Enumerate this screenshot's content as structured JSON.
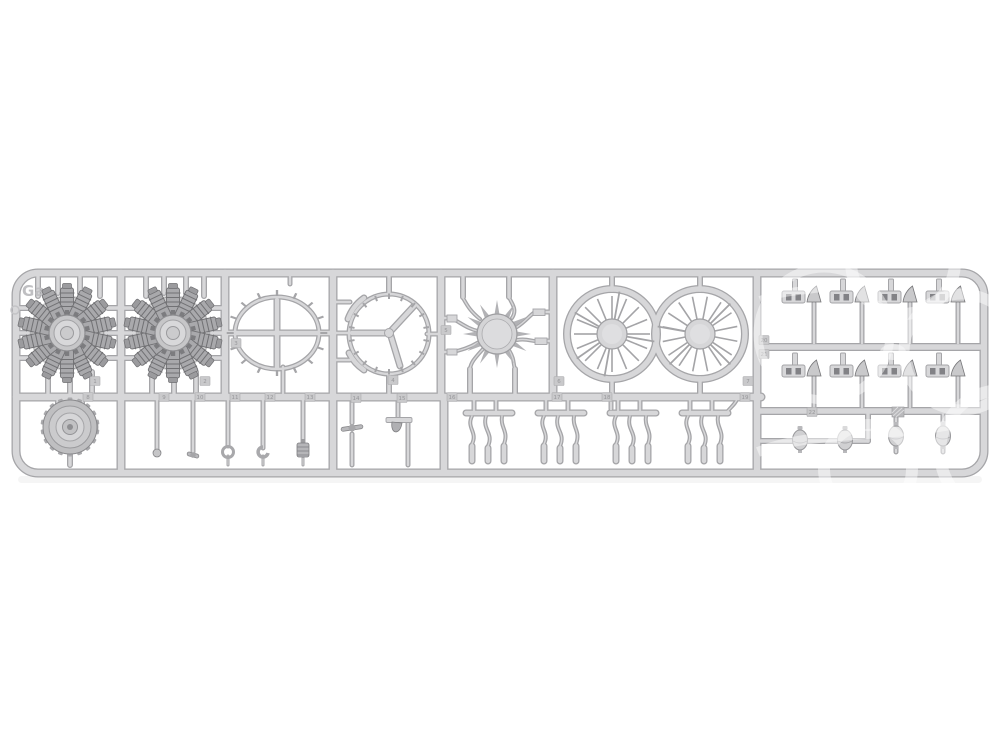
{
  "description": "Photograph of a light-grey injection-moulded model kit sprue (runner frame) containing radial aircraft engine parts, shown horizontally on a white background with a faint white shop watermark over its right side",
  "sprue": {
    "letter": "Ga",
    "shape": "long rounded-corner rectangle frame with internal cell dividers",
    "parts": [
      {
        "name": "radial-engine-cylinder-star-left",
        "tag": "1"
      },
      {
        "name": "radial-engine-cylinder-star-right",
        "tag": "2"
      },
      {
        "name": "cowling-ring-with-cross-brace",
        "tag": "3"
      },
      {
        "name": "cowling-ring-with-y-brace",
        "tag": "4"
      },
      {
        "name": "crankcase-front-with-curved-pushrod-tubes",
        "tag": "5"
      },
      {
        "name": "ignition-harness-spoked-ring-left",
        "tag": "6"
      },
      {
        "name": "ignition-harness-spoked-ring-right",
        "tag": "7"
      },
      {
        "name": "toothed-gear-housing-drum",
        "tag": "8"
      },
      {
        "name": "small-detail-parts-row",
        "tag": "9-15"
      },
      {
        "name": "exhaust-pipe-clusters",
        "tag": "16-19"
      },
      {
        "name": "rocker-cover-cluster-grid",
        "tag": "20-21"
      },
      {
        "name": "egg-shaped-magneto-parts",
        "tag": "22"
      }
    ]
  },
  "tags": {
    "labels": [
      "1",
      "2",
      "3",
      "4",
      "5",
      "6",
      "7",
      "8",
      "9",
      "10",
      "11",
      "12",
      "13",
      "14",
      "15",
      "16",
      "17",
      "18",
      "19",
      "20",
      "21",
      "22"
    ]
  },
  "colors": {
    "bg": "#ffffff",
    "plastic": "#d7d7d9",
    "edge": "#a5a5a8",
    "edge-dark": "#77777a",
    "part-mid": "#a9a9ac",
    "part-dark": "#828286",
    "spoke": "#a4a4a7",
    "tag": "#c9c9cb",
    "tag-text": "#97979a",
    "emboss": "#bfbfc2",
    "watermark": "#ffffff"
  }
}
